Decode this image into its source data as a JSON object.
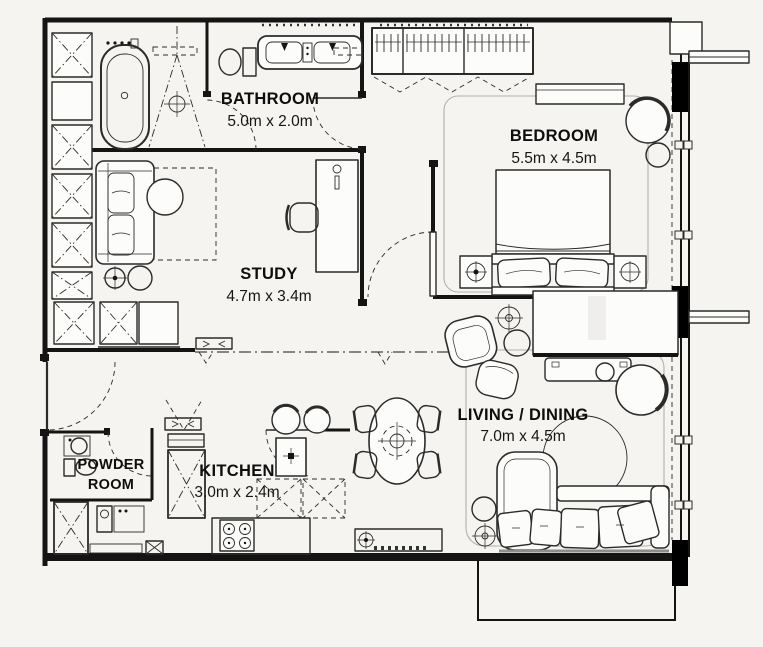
{
  "rooms": {
    "bathroom": {
      "label": "BATHROOM",
      "dims": "5.0m x 2.0m"
    },
    "bedroom": {
      "label": "BEDROOM",
      "dims": "5.5m x 4.5m"
    },
    "study": {
      "label": "STUDY",
      "dims": "4.7m x 3.4m"
    },
    "powder_room": {
      "label_line1": "POWDER",
      "label_line2": "ROOM"
    },
    "kitchen": {
      "label": "KITCHEN",
      "dims": "3.0m x 2.4m"
    },
    "living_dining": {
      "label": "LIVING / DINING",
      "dims": "7.0m x 4.5m"
    }
  },
  "colors": {
    "background": "#f5f4f1",
    "wall": "#141414",
    "furniture_line": "#2b2b2b",
    "label_text": "#0e0e0e"
  }
}
